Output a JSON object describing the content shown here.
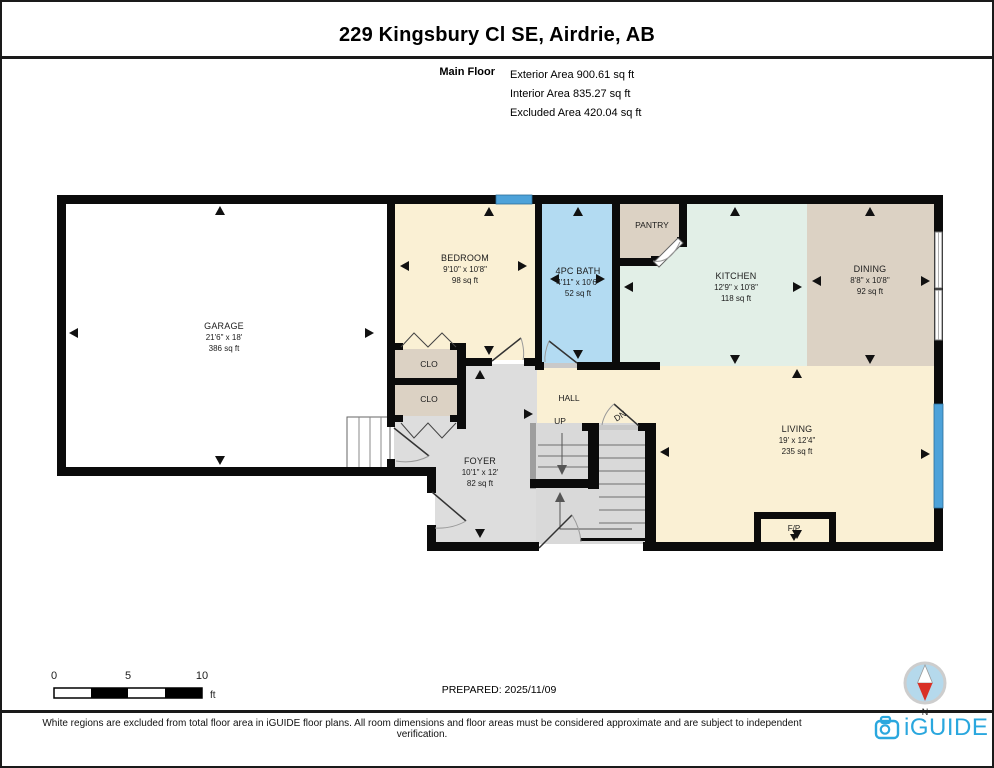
{
  "page": {
    "title": "229 Kingsbury Cl SE, Airdrie, AB",
    "floor_label": "Main Floor",
    "stats": [
      "Exterior Area 900.61 sq ft",
      "Interior Area 835.27 sq ft",
      "Excluded Area 420.04 sq ft"
    ],
    "prepared": "PREPARED: 2025/11/09",
    "disclaimer": "White regions are excluded from total floor area in iGUIDE floor plans. All room dimensions and floor areas must be considered approximate and are subject to independent verification.",
    "brand": "iGUIDE",
    "compass_label": "N"
  },
  "scale_bar": {
    "tick0": "0",
    "tick5": "5",
    "tick10": "10",
    "unit": "ft"
  },
  "rooms": {
    "garage": {
      "name": "GARAGE",
      "dims": "21'6\" x 18'",
      "area": "386 sq ft"
    },
    "bedroom": {
      "name": "BEDROOM",
      "dims": "9'10\" x 10'8\"",
      "area": "98 sq ft"
    },
    "bath": {
      "name": "4PC BATH",
      "dims": "4'11\" x 10'6\"",
      "area": "52 sq ft"
    },
    "pantry": {
      "name": "PANTRY"
    },
    "kitchen": {
      "name": "KITCHEN",
      "dims": "12'9\" x 10'8\"",
      "area": "118 sq ft"
    },
    "dining": {
      "name": "DINING",
      "dims": "8'8\" x 10'8\"",
      "area": "92 sq ft"
    },
    "living": {
      "name": "LIVING",
      "dims": "19' x 12'4\"",
      "area": "235 sq ft"
    },
    "foyer": {
      "name": "FOYER",
      "dims": "10'1\" x 12'",
      "area": "82 sq ft"
    },
    "hall": {
      "name": "HALL"
    },
    "closet": {
      "name": "CLO"
    },
    "fireplace": {
      "name": "F/P"
    },
    "stairs": {
      "up": "UP",
      "down": "DN"
    }
  },
  "colors": {
    "room_cream": "#FAF0D4",
    "bath_blue": "#B3DBF2",
    "kitchen_mint": "#E2EFE7",
    "tan": "#DCD2C4",
    "foyer_gray": "#DDDDDD",
    "stair_gray": "#D9D9D9",
    "window_blue": "#4DA2D9",
    "wall_black": "#0B0B0B",
    "brand_blue": "#2AA7DE",
    "compass_red": "#D93025"
  }
}
